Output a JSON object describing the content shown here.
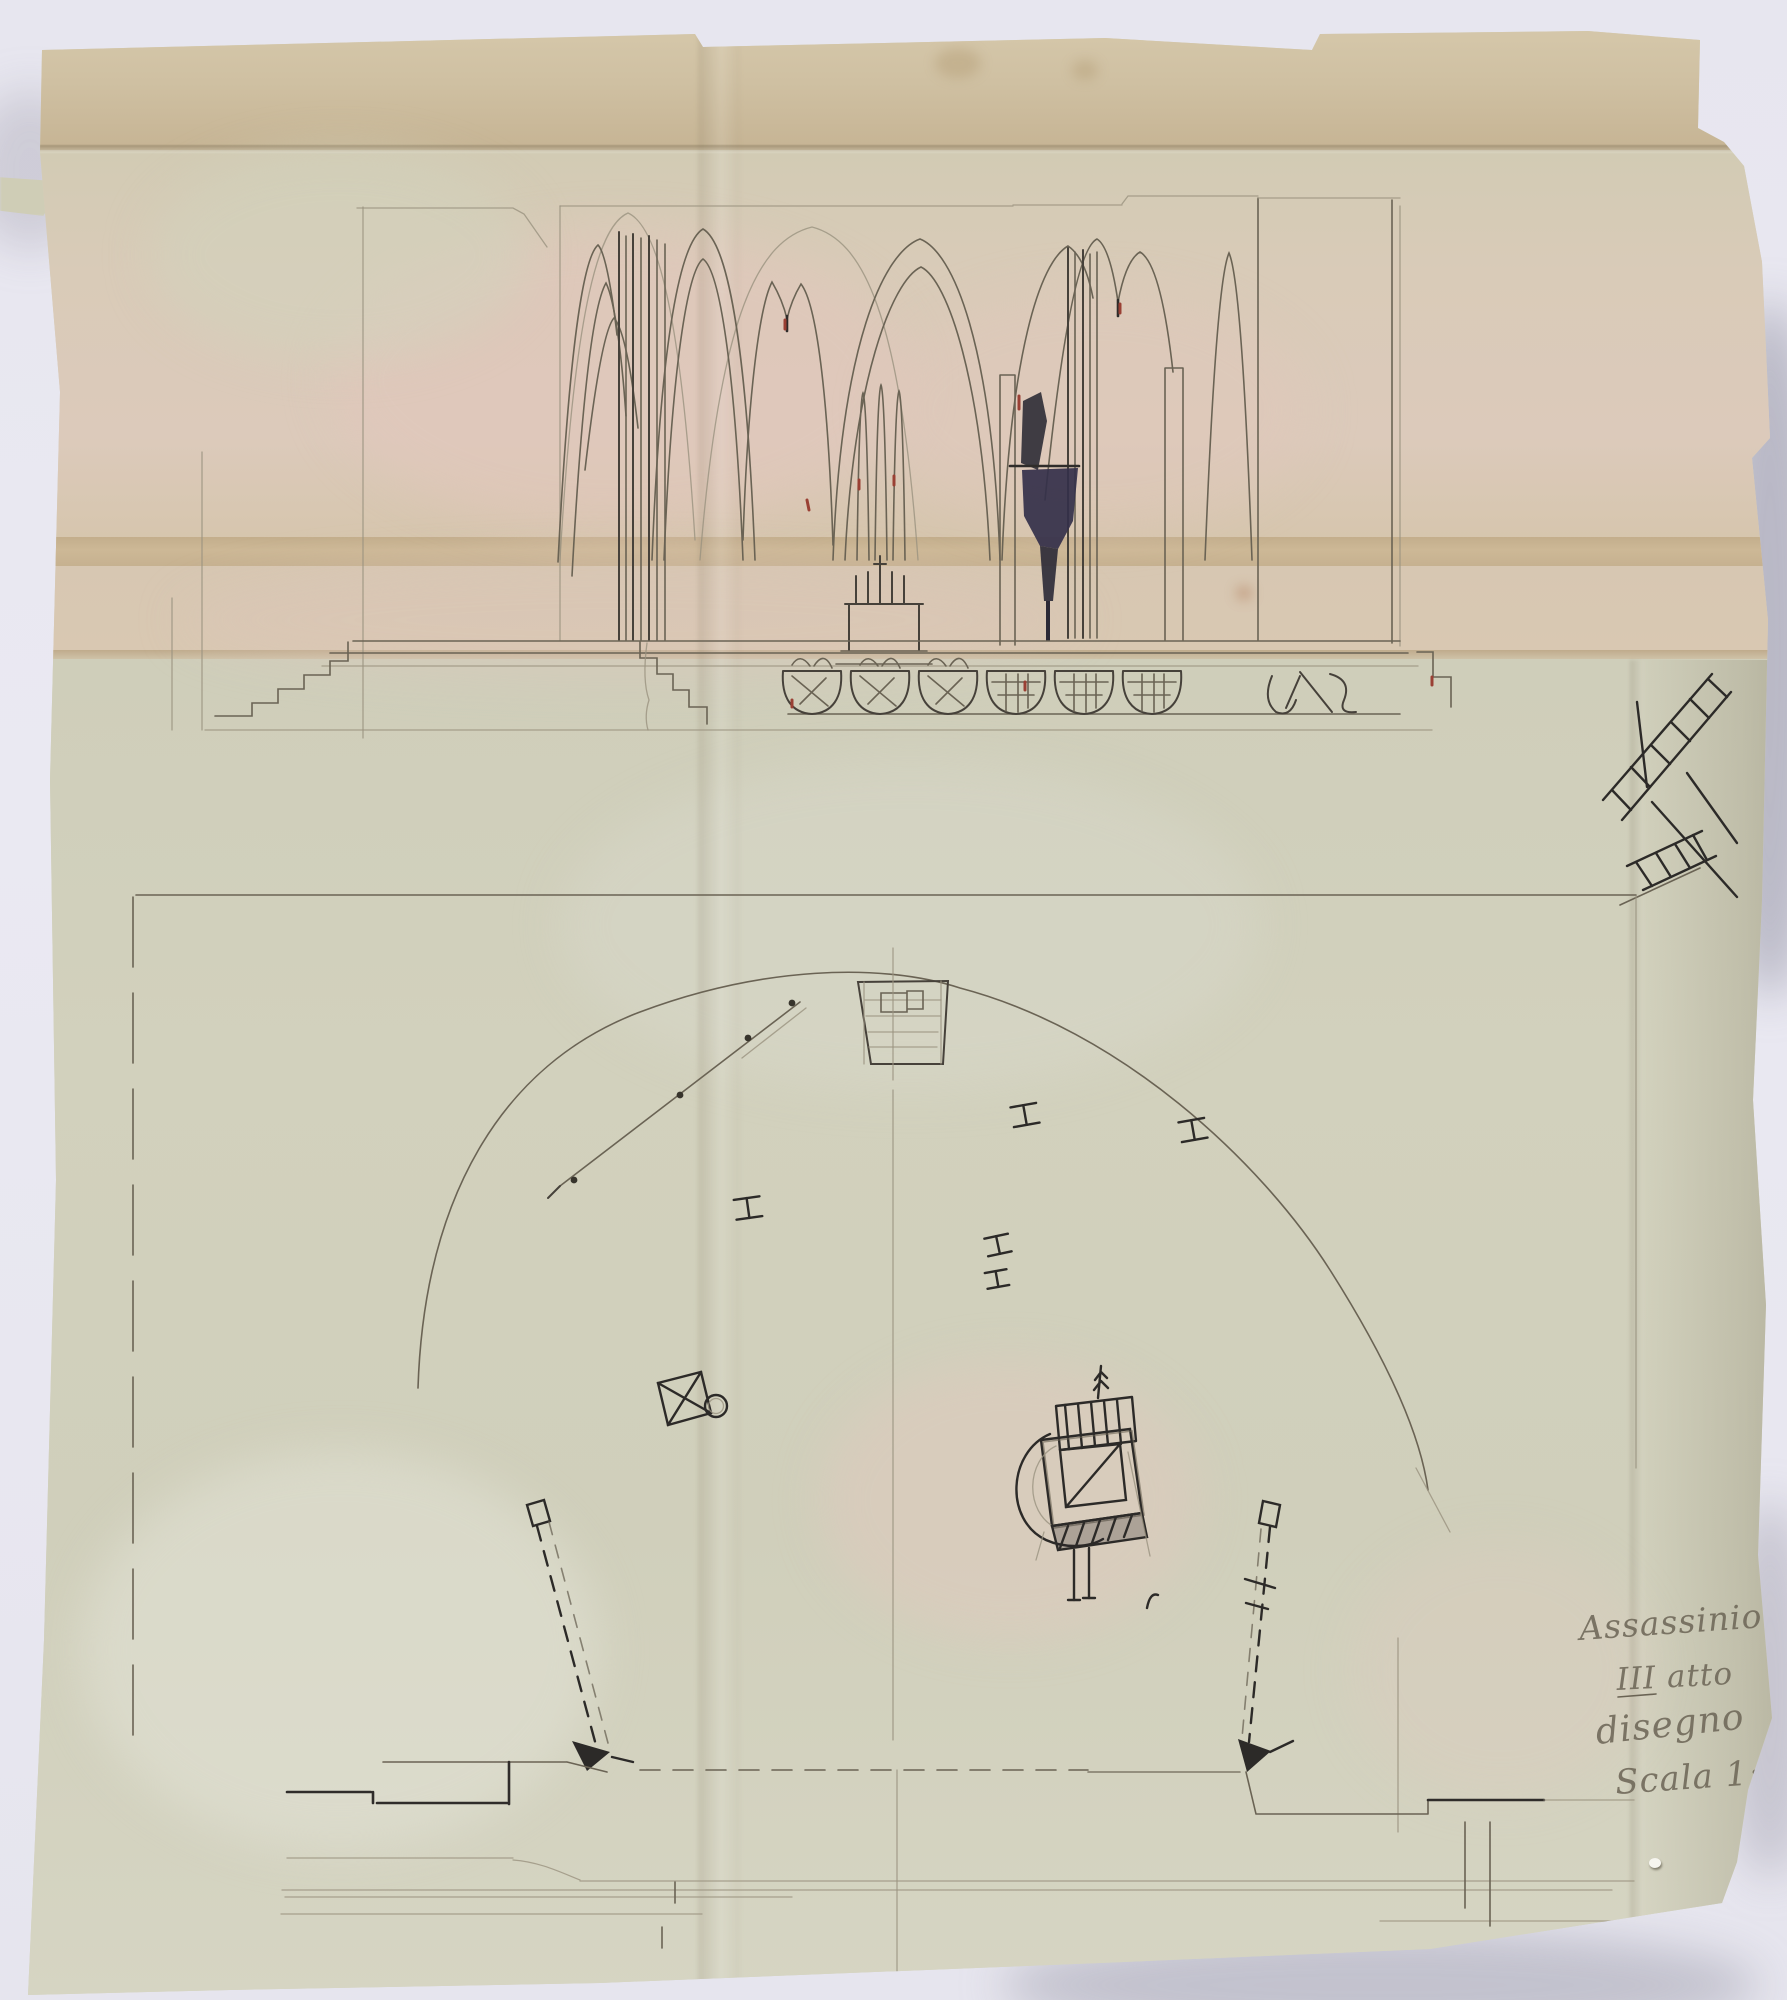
{
  "handwriting": {
    "line1": "Assassinio C",
    "line2": "III atto",
    "line3": "disegno",
    "line4": "Scala 1:"
  },
  "colors": {
    "background": "#e9e8f1",
    "paper_flap_tan": "#cfc0a2",
    "paper_upper_pink_tan": "#d9cbb8",
    "paper_lower_green": "#d1d0bc",
    "crease_tan": "#cbb795",
    "pencil_graphite": "#55504a",
    "ink_dark": "#2c2a28",
    "accent_red": "#9a4034"
  }
}
